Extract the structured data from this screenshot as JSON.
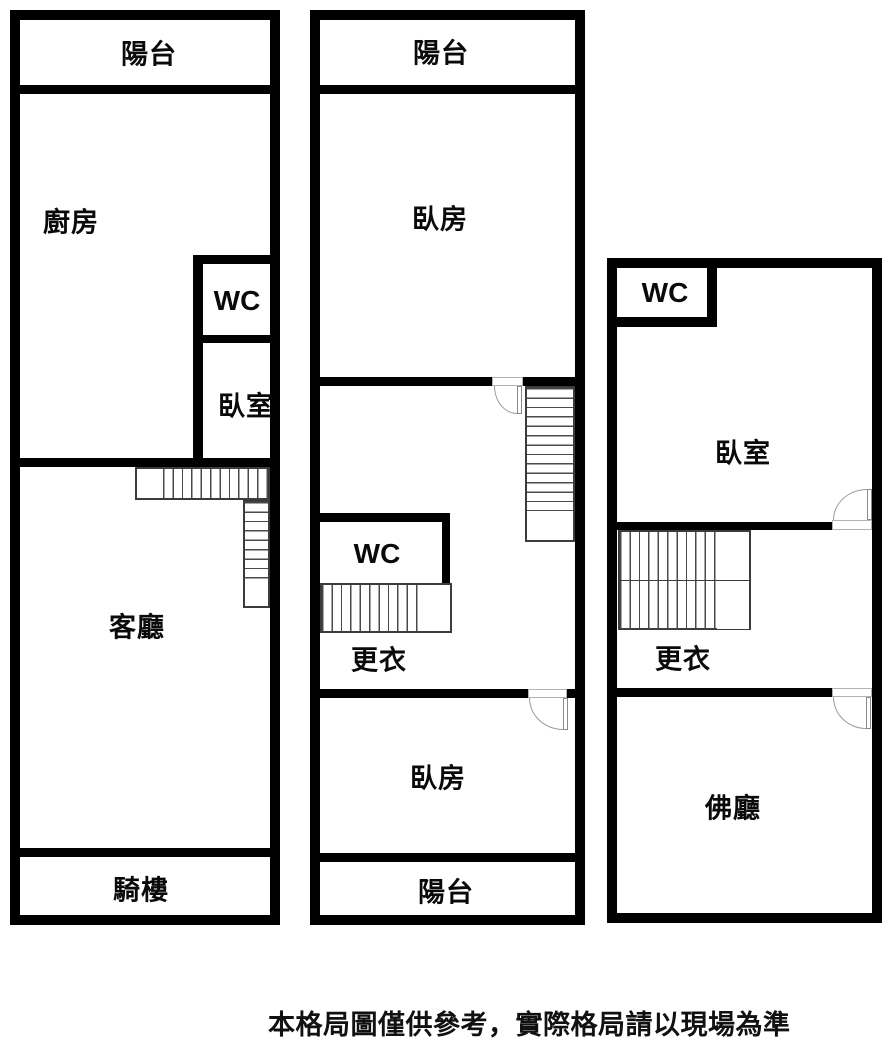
{
  "floor1": {
    "balcony": "陽台",
    "kitchen": "廚房",
    "wc": "WC",
    "bedroom": "臥室",
    "living_room": "客廳",
    "arcade": "騎樓"
  },
  "floor2": {
    "balcony_top": "陽台",
    "bedroom_top": "臥房",
    "wc": "WC",
    "dressing": "更衣",
    "bedroom_bottom": "臥房",
    "balcony_bottom": "陽台"
  },
  "floor3": {
    "wc": "WC",
    "bedroom": "臥室",
    "dressing": "更衣",
    "buddha_hall": "佛廳"
  },
  "footer": {
    "disclaimer": "本格局圖僅供參考，實際格局請以現場為準"
  },
  "colors": {
    "wall": "#000000",
    "background": "#ffffff",
    "stair_line": "#4a4a4a",
    "door_line": "#9a9a9a"
  }
}
